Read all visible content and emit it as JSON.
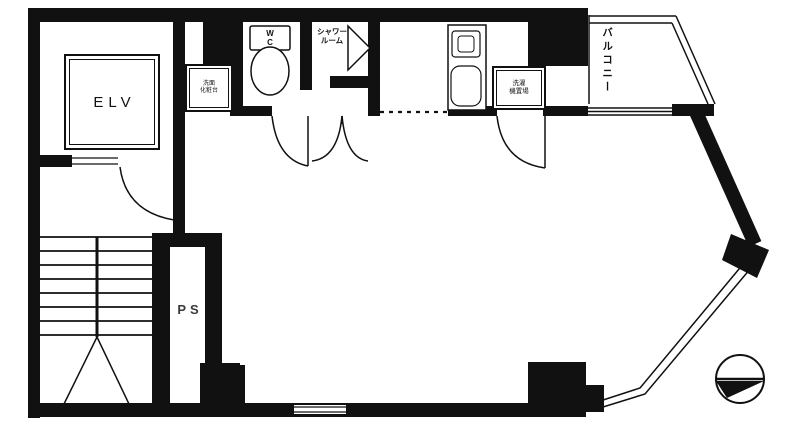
{
  "drawing": {
    "type": "architectural-floor-plan",
    "style": "black-and-white line drawing"
  },
  "colors": {
    "ink": "#111111",
    "background": "#ffffff",
    "muted_label": "#3a3a3a"
  },
  "rooms": {
    "elevator": {
      "label": "ELV"
    },
    "pipe_space": {
      "label": "PS"
    },
    "wc": {
      "label_lines": [
        "W",
        "C"
      ]
    },
    "shower_room": {
      "label_lines": [
        "シャワー",
        "ルーム"
      ]
    },
    "balcony": {
      "label": "バルコニー"
    }
  },
  "fixtures": {
    "washstand": {
      "label_lines": [
        "洗面",
        "化粧台"
      ]
    },
    "laundry_space": {
      "label_lines": [
        "洗濯",
        "機置場"
      ]
    }
  },
  "symbols": {
    "north_indicator": "north-compass-circle",
    "stairs": "staircase-with-direction-arrow",
    "doors": "quarter-arc door swings",
    "windows": "double-line window bands"
  }
}
